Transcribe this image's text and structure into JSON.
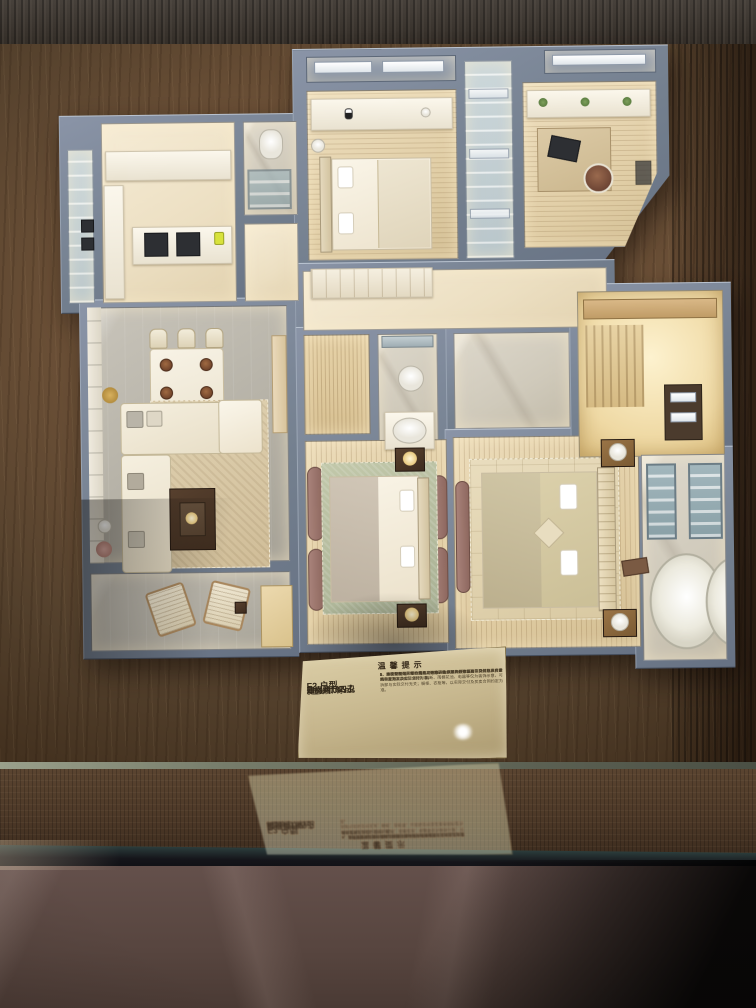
{
  "plaque": {
    "title": "温馨提示",
    "specs": {
      "unit": "F2 户型",
      "area": "建面约187㎡",
      "layout": "四房两厅四卫",
      "scale": "模型比例：约1:25"
    },
    "notes": [
      "1、本模型仅为户型布置格局示意，仅供客户参考使用，具体以政府最终审定方案及实际交付为准。",
      "2、交付标准以买卖合同约定为准，本模型的外立面与实际颜色、材质或有差别，以实际交付为准。",
      "3、因工艺所限，部分构件为示意表达，灯具灯带示意非交付标准；家具、家电、饰品、窗帘、隔断、雨棚花池、电器等仅为装饰示意，可拆卸与实际交付无关；橱柜、衣柜等，以实际交付及买卖合同约定为准。",
      "4、本户型空间尺寸、格局、朝向等为示意，具体以实际交付及买卖合同约定为准。",
      "5、本模型制作比例约1:25，制作日期2024年5月25日。"
    ]
  },
  "colors": {
    "wall": "#76828f",
    "floor_warm": "#efe3c8",
    "floor_marble": "#d2cdbf",
    "table_wood": "#6a4f36",
    "plaque": "#c9b98f",
    "curtain_mauve": "#9b7468",
    "rug_sage": "#b7bfa4",
    "glow": "#f7ecd2"
  }
}
